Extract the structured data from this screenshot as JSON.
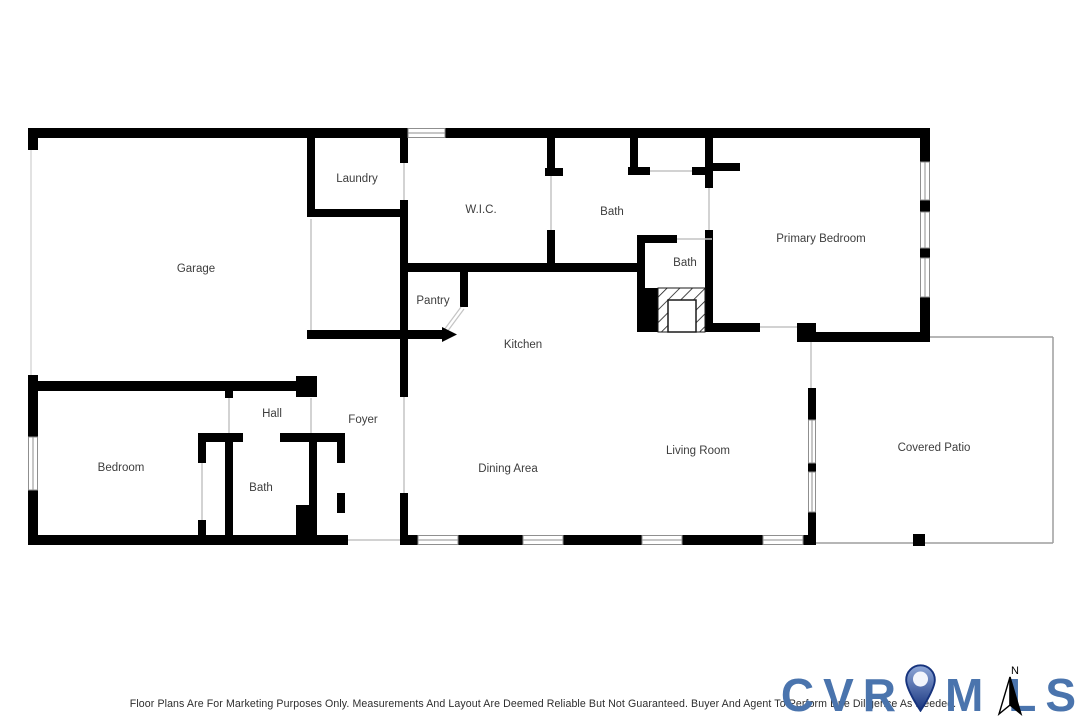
{
  "rooms": {
    "garage": "Garage",
    "laundry": "Laundry",
    "wic": "W.I.C.",
    "bath_top": "Bath",
    "primary_bedroom": "Primary Bedroom",
    "bath_middle": "Bath",
    "pantry": "Pantry",
    "kitchen": "Kitchen",
    "hall": "Hall",
    "foyer": "Foyer",
    "bedroom": "Bedroom",
    "bath_lower": "Bath",
    "dining": "Dining Area",
    "living": "Living Room",
    "covered_patio": "Covered Patio"
  },
  "compass": {
    "north_label": "N"
  },
  "footer": {
    "disclaimer": "Floor Plans Are For Marketing Purposes Only. Measurements And Layout Are Deemed Reliable But Not Guaranteed. Buyer And Agent To Perform Due Diligence As Needed."
  },
  "logo": {
    "c": "C",
    "v": "V",
    "r": "R",
    "m": "M",
    "l": "L",
    "s": "S",
    "color": "#4a74ad",
    "pin_color_dark": "#1d3d85",
    "pin_color_light": "#8fa8d8"
  }
}
